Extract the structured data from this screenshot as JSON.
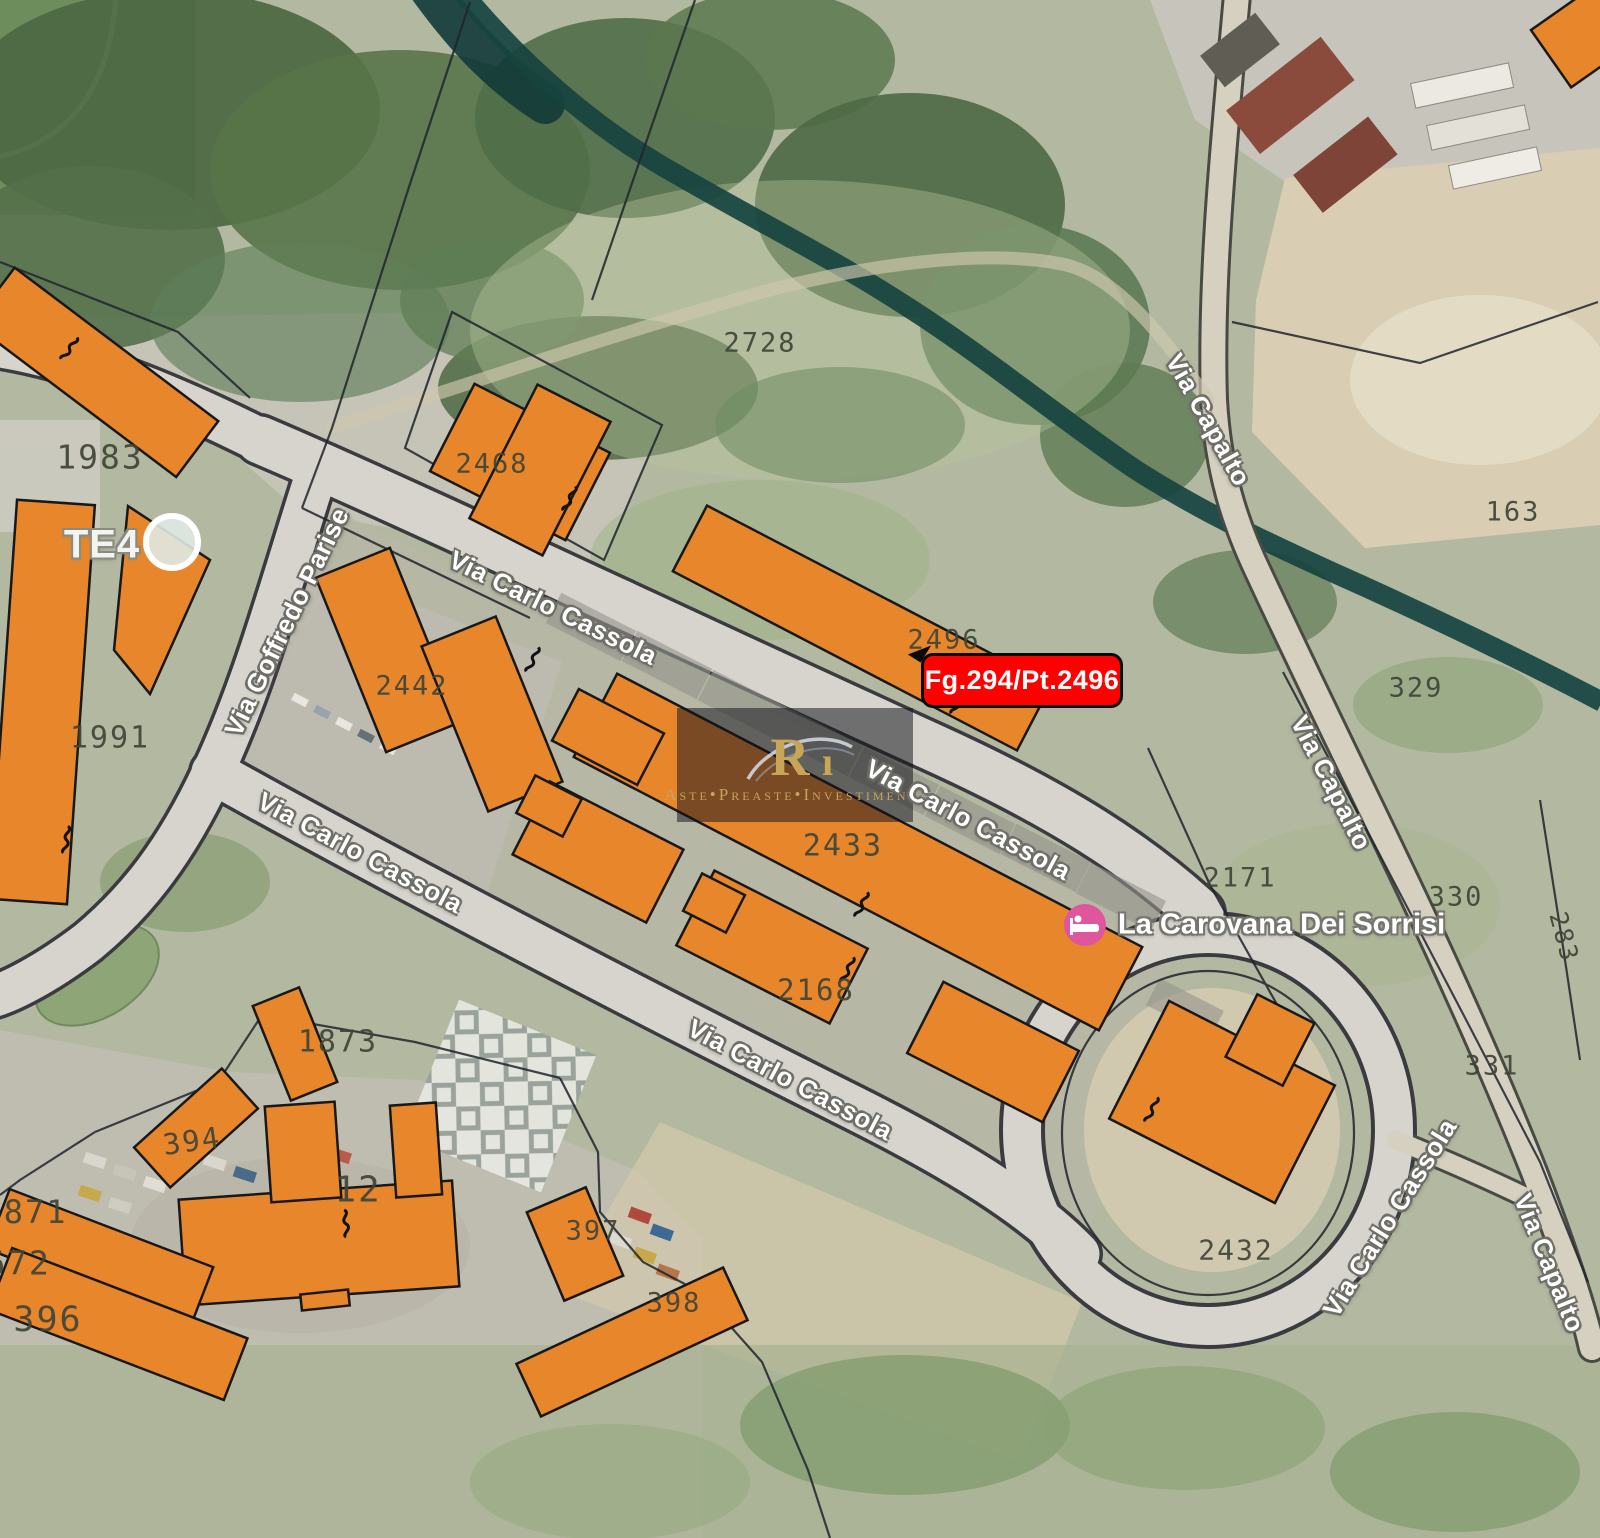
{
  "map": {
    "type": "cadastral-satellite-map",
    "red_callout": {
      "text": "Fg.294/Pt.2496"
    },
    "watermark": {
      "brand_text": "Aste•Preaste•Investimenti",
      "monogram": "R"
    },
    "poi": {
      "name": "La Carovana Dei Sorrisi",
      "icon": "lodging-icon"
    },
    "transit_label": {
      "text": "TE4"
    },
    "colors": {
      "building_fill": "#e8862c",
      "building_stroke": "#181818",
      "boundary_line": "#20242e",
      "stream": "#174340",
      "road_fill": "#d6d4cd",
      "road_casing": "#3a3a40",
      "parcel_text": "#3f4438",
      "street_text": "#ffffff",
      "street_halo": "#6f6f68",
      "callout_bg": "#ff0000",
      "callout_text": "#ffffff",
      "poi_pink": "#e0569e",
      "watermark_gold": "#c6a45d"
    },
    "street_labels": [
      {
        "text": "Via Goffredo Parise",
        "x": 287,
        "y": 622,
        "rotate": -64
      },
      {
        "text": "Via Carlo Cassola",
        "x": 553,
        "y": 608,
        "rotate": 26
      },
      {
        "text": "Via Carlo Cassola",
        "x": 968,
        "y": 820,
        "rotate": 28
      },
      {
        "text": "Via Carlo Cassola",
        "x": 360,
        "y": 853,
        "rotate": 28
      },
      {
        "text": "Via Carlo Cassola",
        "x": 790,
        "y": 1080,
        "rotate": 28
      },
      {
        "text": "Via Carlo Cassola",
        "x": 1390,
        "y": 1218,
        "rotate": -58
      },
      {
        "text": "Via Capalto",
        "x": 1208,
        "y": 420,
        "rotate": 61
      },
      {
        "text": "Via Capalto",
        "x": 1331,
        "y": 783,
        "rotate": 63
      },
      {
        "text": "Via Capalto",
        "x": 1549,
        "y": 1263,
        "rotate": 68
      }
    ],
    "parcel_labels": [
      {
        "text": "2728",
        "x": 760,
        "y": 343,
        "size": 27
      },
      {
        "text": "1983",
        "x": 100,
        "y": 457,
        "size": 33
      },
      {
        "text": "2468",
        "x": 492,
        "y": 464,
        "size": 27
      },
      {
        "text": "2442",
        "x": 412,
        "y": 686,
        "size": 27
      },
      {
        "text": "2496",
        "x": 944,
        "y": 640,
        "size": 27
      },
      {
        "text": "1991",
        "x": 110,
        "y": 738,
        "size": 30
      },
      {
        "text": "163",
        "x": 1513,
        "y": 512,
        "size": 27
      },
      {
        "text": "329",
        "x": 1416,
        "y": 688,
        "size": 27
      },
      {
        "text": "2171",
        "x": 1240,
        "y": 878,
        "size": 27
      },
      {
        "text": "330",
        "x": 1456,
        "y": 897,
        "size": 27
      },
      {
        "text": "2433",
        "x": 843,
        "y": 846,
        "size": 30
      },
      {
        "text": "2168",
        "x": 816,
        "y": 990,
        "size": 29
      },
      {
        "text": "1873",
        "x": 338,
        "y": 1042,
        "size": 30
      },
      {
        "text": "394",
        "x": 192,
        "y": 1141,
        "size": 29,
        "rotate": -8
      },
      {
        "text": "12",
        "x": 358,
        "y": 1190,
        "size": 36
      },
      {
        "text": "1871",
        "x": 25,
        "y": 1212,
        "size": 32
      },
      {
        "text": "672",
        "x": 18,
        "y": 1263,
        "size": 33
      },
      {
        "text": "396",
        "x": 48,
        "y": 1320,
        "size": 35
      },
      {
        "text": "397",
        "x": 593,
        "y": 1231,
        "size": 27
      },
      {
        "text": "398",
        "x": 674,
        "y": 1303,
        "size": 27
      },
      {
        "text": "2432",
        "x": 1236,
        "y": 1250,
        "size": 28
      },
      {
        "text": "331",
        "x": 1492,
        "y": 1066,
        "size": 27
      },
      {
        "text": "283",
        "x": 1564,
        "y": 937,
        "size": 25,
        "rotate": 75
      }
    ]
  }
}
